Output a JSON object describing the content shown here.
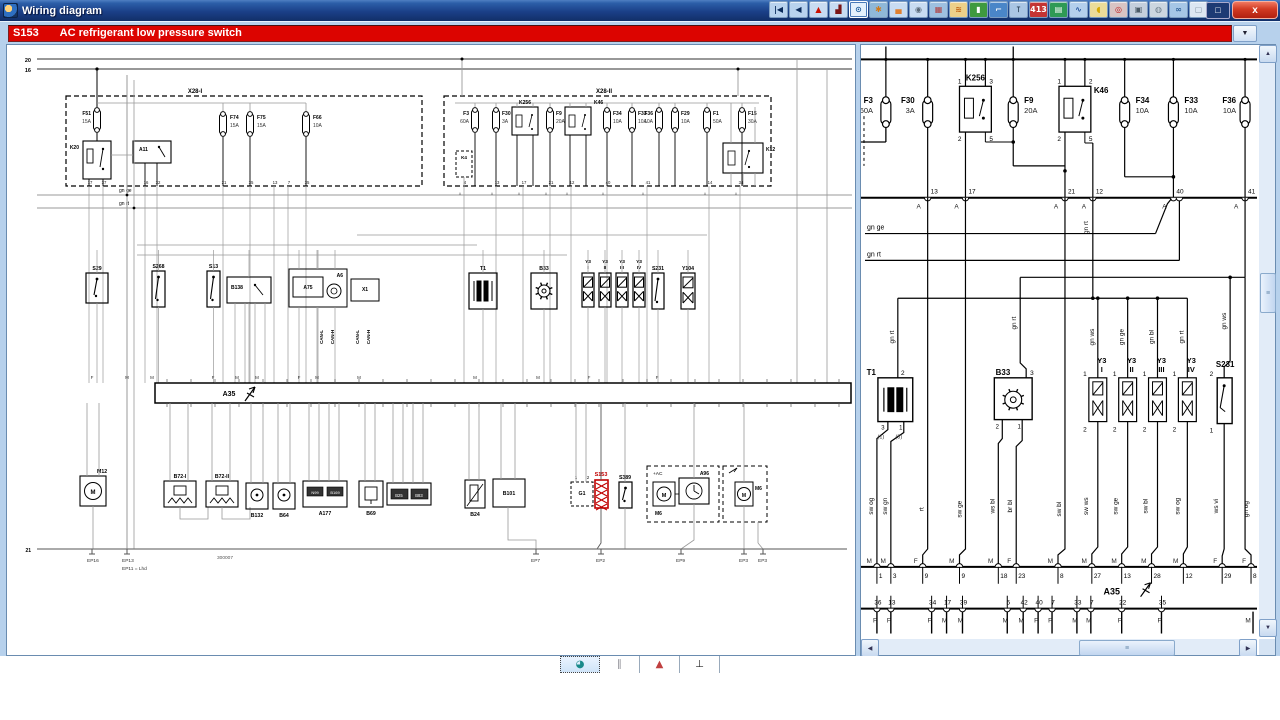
{
  "window": {
    "title": "Wiring diagram",
    "close_glyph": "x",
    "minimize_glyph": "□"
  },
  "titlebar_icons": [
    {
      "name": "go-first-button",
      "glyph": "|◀",
      "fg": "#0a2a5a",
      "bg": "#b8d2ee"
    },
    {
      "name": "go-back-button",
      "glyph": "◀",
      "fg": "#0a2a5a",
      "bg": "#b8d2ee"
    },
    {
      "name": "warning-button",
      "glyph": "▲",
      "fg": "#cc1100",
      "bg": "#c8dcf2"
    },
    {
      "name": "press-tool-button",
      "glyph": "▟",
      "fg": "#7a1515",
      "bg": "#c8dcf2"
    },
    {
      "name": "zoom-view-button",
      "glyph": "⊙",
      "fg": "#1a5a9a",
      "bg": "#e4f0fc",
      "selected": true
    },
    {
      "name": "service-gears-button",
      "glyph": "✱",
      "fg": "#d07818",
      "bg": "#8fb8d8"
    },
    {
      "name": "body-car-button",
      "glyph": "▄",
      "fg": "#e08030",
      "bg": "#c8dcf2"
    },
    {
      "name": "wheel-button",
      "glyph": "◉",
      "fg": "#5a6a7a",
      "bg": "#c8dcf2"
    },
    {
      "name": "engine-button",
      "glyph": "▦",
      "fg": "#b04040",
      "bg": "#9ec0e0"
    },
    {
      "name": "heating-button",
      "glyph": "≋",
      "fg": "#c06010",
      "bg": "#ecd08a"
    },
    {
      "name": "door-button",
      "glyph": "▮",
      "fg": "#ffffff",
      "bg": "#3f9a3f"
    },
    {
      "name": "towing-button",
      "glyph": "⌐",
      "fg": "#ffffff",
      "bg": "#4a86c8"
    },
    {
      "name": "spark-plug-button",
      "glyph": "⊺",
      "fg": "#30475e",
      "bg": "#aac6e4"
    },
    {
      "name": "firing-order-button",
      "glyph": "413",
      "fg": "#ffffff",
      "bg": "#c43434"
    },
    {
      "name": "printout-button",
      "glyph": "▤",
      "fg": "#ffffff",
      "bg": "#2f9a55"
    },
    {
      "name": "hose-button",
      "glyph": "∿",
      "fg": "#2a58a0",
      "bg": "#b4cfec"
    },
    {
      "name": "lambda-button",
      "glyph": "◖",
      "fg": "#d8a800",
      "bg": "#ecdc9a"
    },
    {
      "name": "brake-button",
      "glyph": "◎",
      "fg": "#c02020",
      "bg": "#d8c4c4"
    },
    {
      "name": "engine-block-button",
      "glyph": "▣",
      "fg": "#4a5a66",
      "bg": "#c4cfdc"
    },
    {
      "name": "airbag-button",
      "glyph": "◍",
      "fg": "#70808e",
      "bg": "#ccd6e0"
    },
    {
      "name": "motorcycle-button",
      "glyph": "∞",
      "fg": "#2f6098",
      "bg": "#a6c6e6"
    },
    {
      "name": "accessory-button",
      "glyph": "▢",
      "fg": "#8898a8",
      "bg": "#dce6f2"
    }
  ],
  "selector": {
    "code": "S153",
    "label": "AC refrigerant low pressure switch",
    "dropdown_glyph": "▼"
  },
  "scrollbars": {
    "up": "▲",
    "down": "▼",
    "left": "◀",
    "right": "▶",
    "grip": "≡"
  },
  "left_diagram": {
    "bus_labels": [
      "20",
      "16"
    ],
    "bus_bottom_label": "21",
    "boxes": [
      {
        "id": "X28-I"
      },
      {
        "id": "X28-II"
      }
    ],
    "box1_parts": [
      {
        "id": "F51",
        "amp": "15A"
      },
      {
        "id": "K20"
      },
      {
        "id": "A11"
      },
      {
        "id": "F74",
        "amp": "15A"
      },
      {
        "id": "F75",
        "amp": "15A"
      },
      {
        "id": "F66",
        "amp": "10A"
      }
    ],
    "box1_pins": [
      "17",
      "37",
      "16",
      "32",
      "21",
      "35",
      "13",
      "7",
      "35"
    ],
    "box2_parts": [
      {
        "id": "K4"
      },
      {
        "id": "F3",
        "amp": "60A"
      },
      {
        "id": "F30",
        "amp": "3A"
      },
      {
        "id": "K256"
      },
      {
        "id": "F9",
        "amp": "20A"
      },
      {
        "id": "K46"
      },
      {
        "id": "F34",
        "amp": "10A"
      },
      {
        "id": "F33",
        "amp": "10A"
      },
      {
        "id": "F36",
        "amp": "10A"
      },
      {
        "id": "F29",
        "amp": "10A"
      },
      {
        "id": "F1",
        "amp": "50A"
      },
      {
        "id": "F15",
        "amp": "30A"
      },
      {
        "id": "K12"
      }
    ],
    "box2_pins": [
      "4",
      "13",
      "17",
      "21",
      "12",
      "40",
      "41",
      "14",
      "34"
    ],
    "trunk_labels": [
      "gn ge",
      "gn rt"
    ],
    "mid_parts": [
      {
        "id": "S29"
      },
      {
        "id": "S268"
      },
      {
        "id": "S13"
      },
      {
        "id": "B138"
      },
      {
        "id": "A6"
      },
      {
        "id": "A75"
      },
      {
        "id": "X1"
      },
      {
        "id": "T1"
      },
      {
        "id": "B33"
      },
      {
        "id": "Y3",
        "sub": "I"
      },
      {
        "id": "Y3",
        "sub": "II"
      },
      {
        "id": "Y3",
        "sub": "III"
      },
      {
        "id": "Y3",
        "sub": "IV"
      },
      {
        "id": "S231"
      },
      {
        "id": "Y104"
      }
    ],
    "can_labels": [
      "CAN-L",
      "CAN-H"
    ],
    "connector_letters": [
      "F",
      "M",
      "M",
      "F",
      "M",
      "M",
      "F",
      "M",
      "M",
      "M",
      "M",
      "F",
      "F"
    ],
    "ecu": {
      "id": "A35"
    },
    "bottom_parts": [
      {
        "id": "M12"
      },
      {
        "id": "B72-I"
      },
      {
        "id": "B72-II"
      },
      {
        "id": "B132"
      },
      {
        "id": "B64"
      },
      {
        "id": "A177",
        "inner": [
          "N99",
          "B169"
        ]
      },
      {
        "id": "B69"
      },
      {
        "id": "B25"
      },
      {
        "id": "B83"
      },
      {
        "id": "B24"
      },
      {
        "id": "B101"
      },
      {
        "id": "G1",
        "pins": [
          "1",
          "2"
        ]
      },
      {
        "id": "S153",
        "highlight": true
      },
      {
        "id": "S389"
      }
    ],
    "ac_cluster": {
      "tag": "+AC",
      "module": "A96",
      "motor_left": "M6",
      "motor_right": "M6"
    },
    "ground_labels": [
      "EP16",
      "EP13",
      "EP7",
      "EP2",
      "EP9",
      "EP3",
      "EP3"
    ],
    "ground_note": "EP11 = Lhd",
    "diagram_number": "300007",
    "highlight_color": "#c00000"
  },
  "right_diagram": {
    "fuses": [
      {
        "id": "F3",
        "amp": "60A"
      },
      {
        "id": "F30",
        "amp": "3A"
      },
      {
        "id": "F9",
        "amp": "20A"
      },
      {
        "id": "F34",
        "amp": "10A"
      },
      {
        "id": "F33",
        "amp": "10A"
      },
      {
        "id": "F36",
        "amp": "10A"
      }
    ],
    "relays": [
      {
        "id": "K256",
        "pins_top": [
          "1",
          "3"
        ],
        "pins_bottom": [
          "2",
          "5"
        ]
      },
      {
        "id": "K46",
        "pins_top": [
          "1",
          "2"
        ],
        "pins_bottom": [
          "2",
          "5"
        ]
      }
    ],
    "bus_pins": [
      "13",
      "17",
      "21",
      "12",
      "40",
      "41"
    ],
    "connector_letter": "A",
    "wire_labels_horizontal": [
      "gn ge",
      "gn rt"
    ],
    "wire_label_pin12": "gn rt",
    "feed_labels": [
      "gn rt",
      "gn rt",
      "gn ws",
      "gn ge",
      "gn bl",
      "gn rt",
      "gn ws"
    ],
    "components": [
      {
        "id": "T1",
        "pin_top": "2",
        "pins_bottom": [
          "3",
          "1"
        ],
        "pins_bottom_alt": [
          "(1)",
          "(3)"
        ]
      },
      {
        "id": "B33",
        "pin_top": "3",
        "pins_bottom": [
          "2",
          "1"
        ]
      },
      {
        "id": "Y3",
        "sub": "I",
        "pin_top": "1",
        "pin_bottom": "2"
      },
      {
        "id": "Y3",
        "sub": "II",
        "pin_top": "1",
        "pin_bottom": "2"
      },
      {
        "id": "Y3",
        "sub": "III",
        "pin_top": "1",
        "pin_bottom": "2"
      },
      {
        "id": "Y3",
        "sub": "IV",
        "pin_top": "1",
        "pin_bottom": "2"
      },
      {
        "id": "S231",
        "pin_top": "2",
        "pin_bottom": "1"
      }
    ],
    "wire_labels_bottom": [
      "sw og",
      "sw gn",
      "rt",
      "sw ge",
      "ws bl",
      "br bl",
      "sw bl",
      "sw ws",
      "sw ge",
      "sw bl",
      "sw og",
      "ws vi",
      "gn og"
    ],
    "ecu_top_connectors": [
      {
        "mf": "M",
        "pin": "1"
      },
      {
        "mf": "M",
        "pin": "3"
      },
      {
        "mf": "F",
        "pin": "9"
      },
      {
        "mf": "M",
        "pin": "9"
      },
      {
        "mf": "M",
        "pin": "18"
      },
      {
        "mf": "F",
        "pin": "23"
      },
      {
        "mf": "M",
        "pin": "8"
      },
      {
        "mf": "M",
        "pin": "27"
      },
      {
        "mf": "M",
        "pin": "13"
      },
      {
        "mf": "M",
        "pin": "28"
      },
      {
        "mf": "M",
        "pin": "12"
      },
      {
        "mf": "F",
        "pin": "29"
      },
      {
        "mf": "F",
        "pin": "8"
      }
    ],
    "ecu": {
      "id": "A35"
    },
    "ecu_bottom_connectors": [
      {
        "pin": "36",
        "mf": "F"
      },
      {
        "pin": "13",
        "mf": "F"
      },
      {
        "pin": "34",
        "mf": "F"
      },
      {
        "pin": "17",
        "mf": "M"
      },
      {
        "pin": "39",
        "mf": "M"
      },
      {
        "pin": "5",
        "mf": "M"
      },
      {
        "pin": "42",
        "mf": "M"
      },
      {
        "pin": "40",
        "mf": "F"
      },
      {
        "pin": "7",
        "mf": "F"
      },
      {
        "pin": "33",
        "mf": "M"
      },
      {
        "pin": "7",
        "mf": "M"
      },
      {
        "pin": "22",
        "mf": "F"
      },
      {
        "pin": "35",
        "mf": "F"
      }
    ],
    "edge_connector": "M"
  },
  "bottom_toolbar": {
    "buttons": [
      {
        "name": "overview-zoom-button",
        "glyph": "◕",
        "fg": "#1a8a8a",
        "selected": true
      },
      {
        "name": "harness-view-button",
        "glyph": "∥",
        "fg": "#8a8a92",
        "selected": false
      },
      {
        "name": "location-view-button",
        "glyph": "▲",
        "fg": "#c04040",
        "selected": false
      },
      {
        "name": "ground-view-button",
        "glyph": "⊥",
        "fg": "#222222",
        "selected": false
      }
    ]
  }
}
